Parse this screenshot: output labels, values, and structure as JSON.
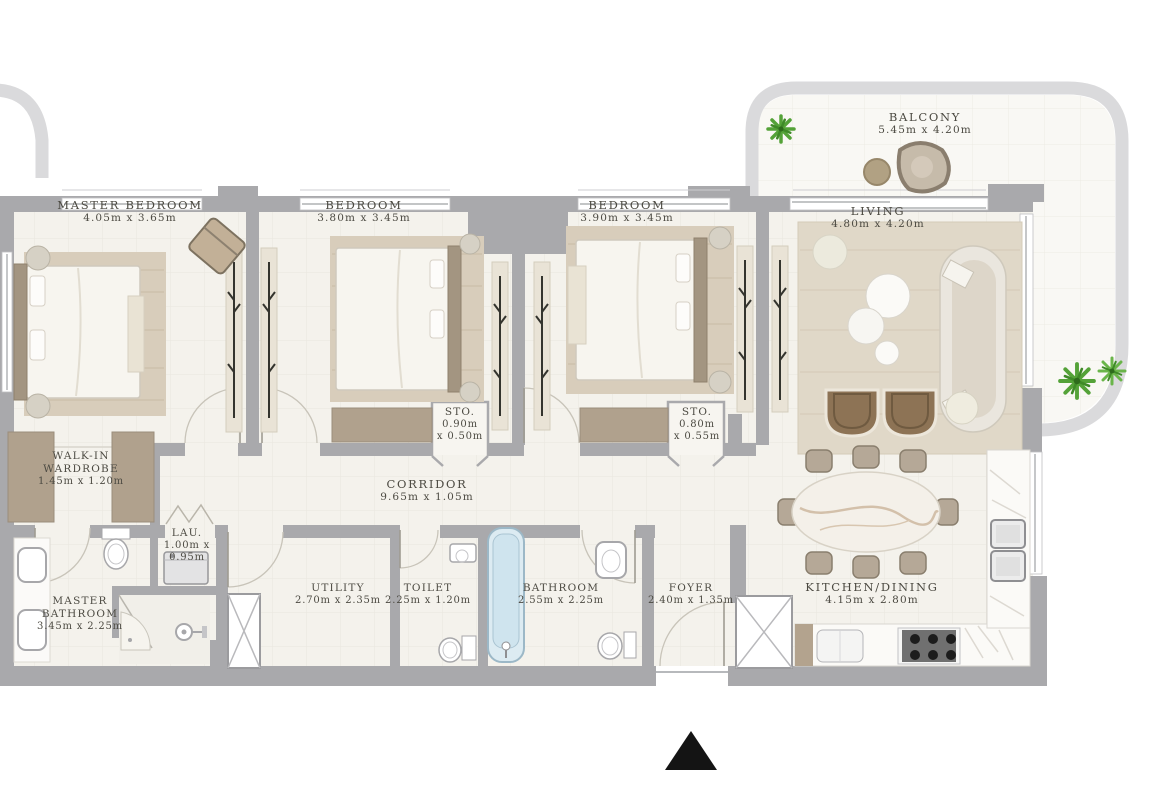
{
  "colors": {
    "background": "#ffffff",
    "wall": "#a9a9ac",
    "balcony_wall": "#dadadc",
    "floor": "#f4f2ec",
    "balcony_floor": "#f9f8f4",
    "label_text": "#4c4a42",
    "wardrobe_block": "#b0a18d",
    "bedroom_rug": "#d8cdbb",
    "living_rug": "#e0d8c8",
    "bathtub_blue": "#cfe4ee",
    "plant_green": "#54a238",
    "armchair_brown": "#8d7355",
    "entrance_arrow": "#141414"
  },
  "rooms": [
    {
      "id": "master-bedroom",
      "name": "MASTER BEDROOM",
      "dims": "4.05m x 3.65m"
    },
    {
      "id": "bedroom-2",
      "name": "BEDROOM",
      "dims": "3.80m x 3.45m"
    },
    {
      "id": "bedroom-3",
      "name": "BEDROOM",
      "dims": "3.90m x 3.45m"
    },
    {
      "id": "living",
      "name": "LIVING",
      "dims": "4.80m x 4.20m"
    },
    {
      "id": "balcony",
      "name": "BALCONY",
      "dims": "5.45m x 4.20m"
    },
    {
      "id": "walk-in-wardrobe",
      "name": "WALK-IN WARDROBE",
      "dims": "1.45m x 1.20m"
    },
    {
      "id": "corridor",
      "name": "CORRIDOR",
      "dims": "9.65m x 1.05m"
    },
    {
      "id": "storage-1",
      "name": "STO.",
      "dims": "0.90m",
      "dims2": "x 0.50m"
    },
    {
      "id": "storage-2",
      "name": "STO.",
      "dims": "0.80m",
      "dims2": "x 0.55m"
    },
    {
      "id": "laundry",
      "name": "LAU.",
      "dims": "1.00m x",
      "dims2": "0.95m"
    },
    {
      "id": "master-bathroom",
      "name": "MASTER BATHROOM",
      "dims": "3.45m x 2.25m"
    },
    {
      "id": "utility",
      "name": "UTILITY",
      "dims": "2.70m x 2.35m"
    },
    {
      "id": "toilet",
      "name": "TOILET",
      "dims": "2.25m x 1.20m"
    },
    {
      "id": "bathroom",
      "name": "BATHROOM",
      "dims": "2.55m x 2.25m"
    },
    {
      "id": "foyer",
      "name": "FOYER",
      "dims": "2.40m x 1.35m"
    },
    {
      "id": "kitchen-dining",
      "name": "KITCHEN/DINING",
      "dims": "4.15m x 2.80m"
    }
  ],
  "icons": {
    "entrance_marker": "north-arrow",
    "plants": "potted-plant",
    "shafts": "service-shaft-x"
  }
}
